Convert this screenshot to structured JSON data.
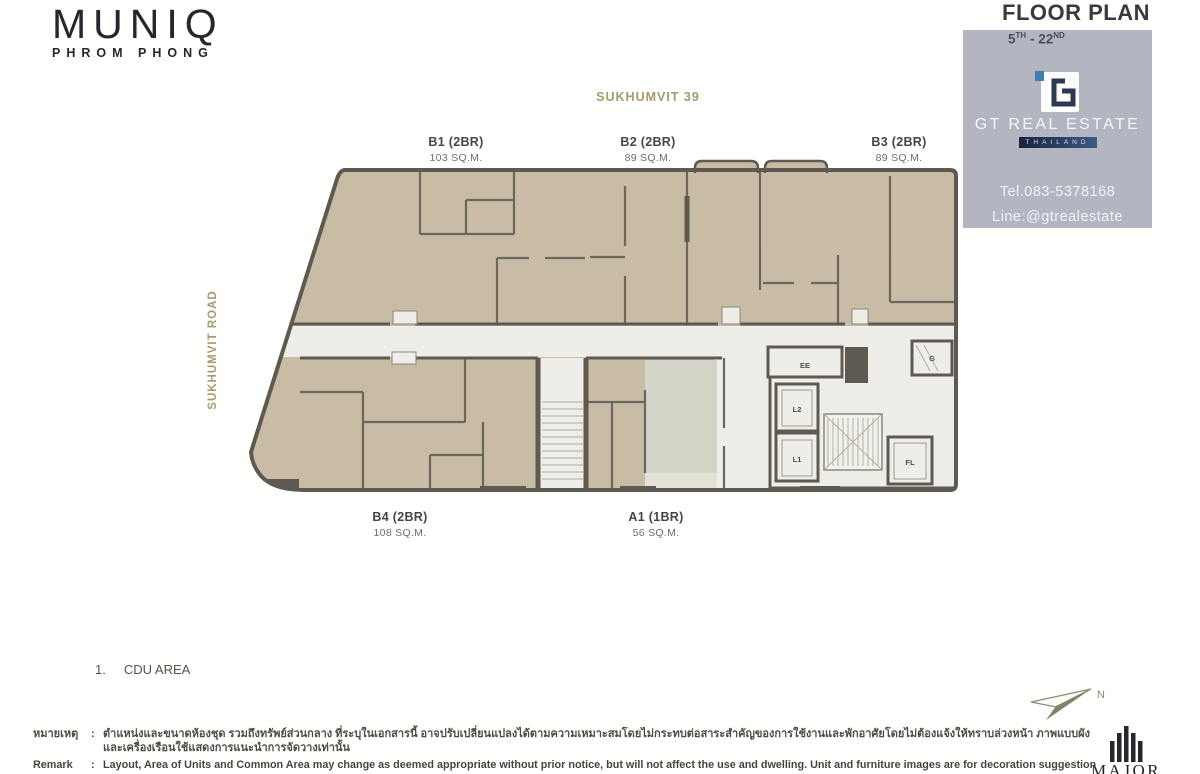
{
  "brand": {
    "name": "MUNIQ",
    "sub": "PHROM PHONG"
  },
  "header": {
    "title": "FLOOR PLAN",
    "floors": {
      "from": "5",
      "from_suffix": "TH",
      "sep": " - ",
      "to": "22",
      "to_suffix": "ND"
    }
  },
  "streets": {
    "top": "SUKHUMVIT 39",
    "left": "SUKHUMVIT ROAD"
  },
  "units": [
    {
      "name": "B1 (2BR)",
      "area": "103 SQ.M."
    },
    {
      "name": "B2 (2BR)",
      "area": "89 SQ.M."
    },
    {
      "name": "B3 (2BR)",
      "area": "89 SQ.M."
    },
    {
      "name": "B4 (2BR)",
      "area": "108 SQ.M."
    },
    {
      "name": "A1 (1BR)",
      "area": "56 SQ.M."
    }
  ],
  "plan": {
    "core": {
      "ee": "EE",
      "g": "G",
      "l2": "L2",
      "l1": "L1",
      "fl": "FL"
    },
    "compass_label": "N"
  },
  "note": {
    "number": "1.",
    "text": "CDU AREA"
  },
  "watermark": {
    "company": "GT REAL ESTATE",
    "country": "THAILAND",
    "tel": "Tel.083-5378168",
    "line": "Line:@gtrealestate"
  },
  "remark": {
    "thai_label": "หมายเหตุ",
    "en_label": "Remark",
    "sep": ":",
    "thai_text": "ตำแหน่งและขนาดห้องชุด รวมถึงทรัพย์ส่วนกลาง ที่ระบุในเอกสารนี้ อาจปรับเปลี่ยนแปลงได้ตามความเหมาะสมโดยไม่กระทบต่อสาระสำคัญของการใช้งานและพักอาศัยโดยไม่ต้องแจ้งให้ทราบล่วงหน้า ภาพแบบผังและเครื่องเรือนใช้แสดงการแนะนำการจัดวางเท่านั้น",
    "en_text": "Layout, Area of Units and Common Area may change as deemed appropriate without prior notice, but will not affect the use and dwelling. Unit and furniture images are for decoration suggestion purpose only."
  },
  "footer_logo": {
    "name": "MAJOR"
  },
  "colors": {
    "unit_fill": "#c9bca5",
    "wall": "#5e5a52",
    "corridor": "#eeede7",
    "a1_fill": "#d3d5c9",
    "accent_gold": "#a69a6e",
    "watermark_bg": "#b0b3be",
    "navy_bar": "#16233c",
    "logo_blue": "#3e7fb0"
  }
}
